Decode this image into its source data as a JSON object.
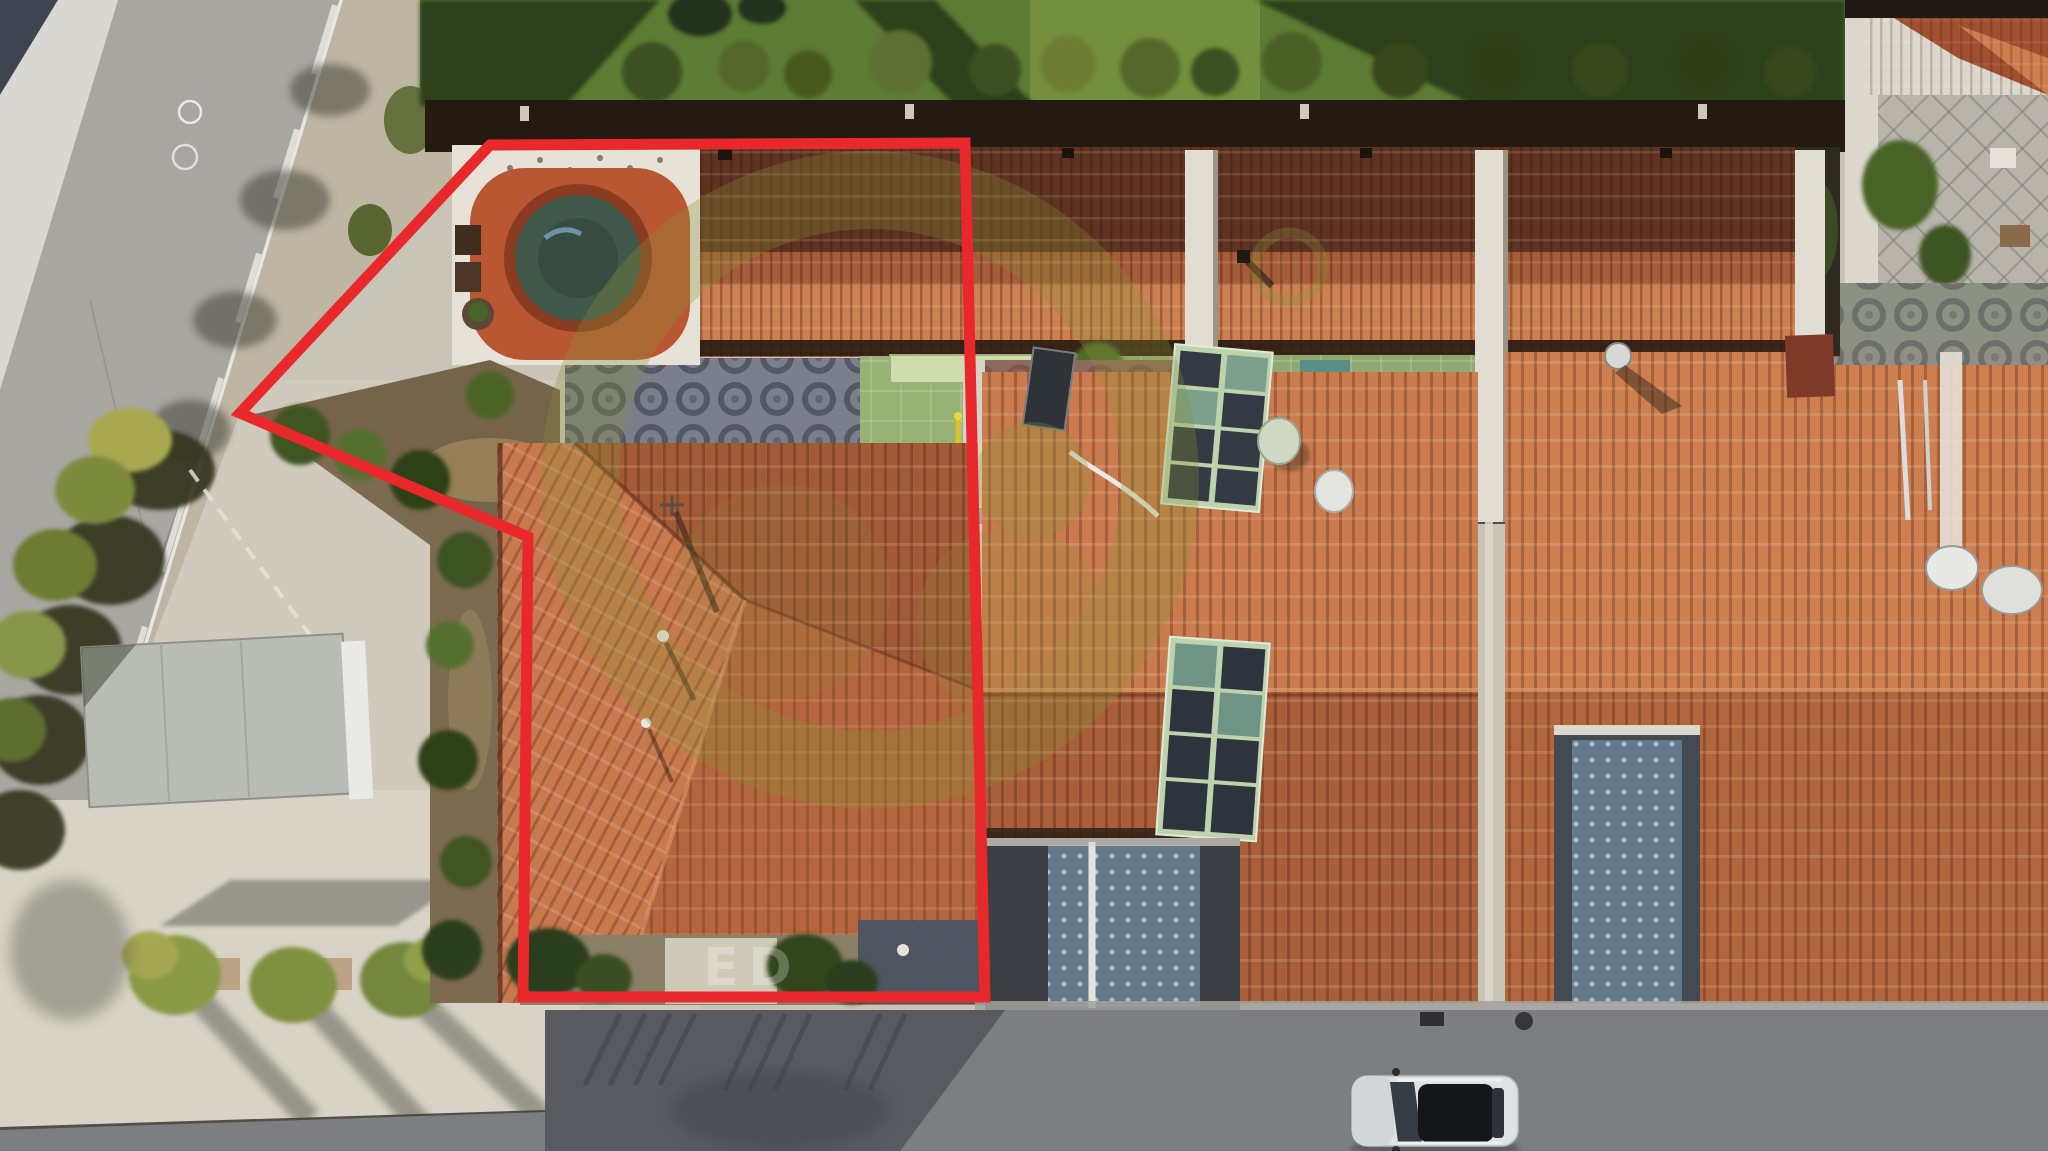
{
  "meta": {
    "description": "Aerial drone photograph of a row of terraced houses with terracotta tile roofs; the subject property is outlined with a thick red boundary polygon and contains a round swimming pool, patios and a large hip roof. A road crosses the top-left corner, a bright concrete forecourt with a flat-roofed garage and a row of small trees occupies the bottom-left, and a shaded street with one parked car runs along the bottom. A semi-transparent olive circular logo watermark overlays the centre."
  },
  "watermark": {
    "visible_text": "ED"
  },
  "palette": {
    "boundary_red": "#e8282b",
    "watermark_olive": "#8b9038",
    "roof_sunlit": "#cd7f50",
    "roof_mid": "#b4663e",
    "roof_shadow": "#6e3b26",
    "pool_water": "#41594a",
    "pool_deck": "#b85732",
    "lawn_green": "#5d7c33",
    "road_gray": "#a8a6a1",
    "plaza_light": "#d6d1c5",
    "street_dark": "#595a60",
    "car_body": "#dfe1e3",
    "solar_frame_green": "#bcd3ae",
    "azulejo_blue": "#64788c"
  },
  "scene": {
    "objects": [
      "red property boundary outline",
      "circular swimming pool with terracotta deck",
      "terracotta tiled hip roofs",
      "roof solar panel arrays",
      "satellite dishes",
      "patio with circle-pattern tiles",
      "green patio with playground",
      "garden lawn with row of shrubs",
      "asphalt road with dashed centre line",
      "flat-roofed garage",
      "row of street trees with long shadows",
      "white parked car on shaded street",
      "olive circular logo watermark"
    ]
  }
}
